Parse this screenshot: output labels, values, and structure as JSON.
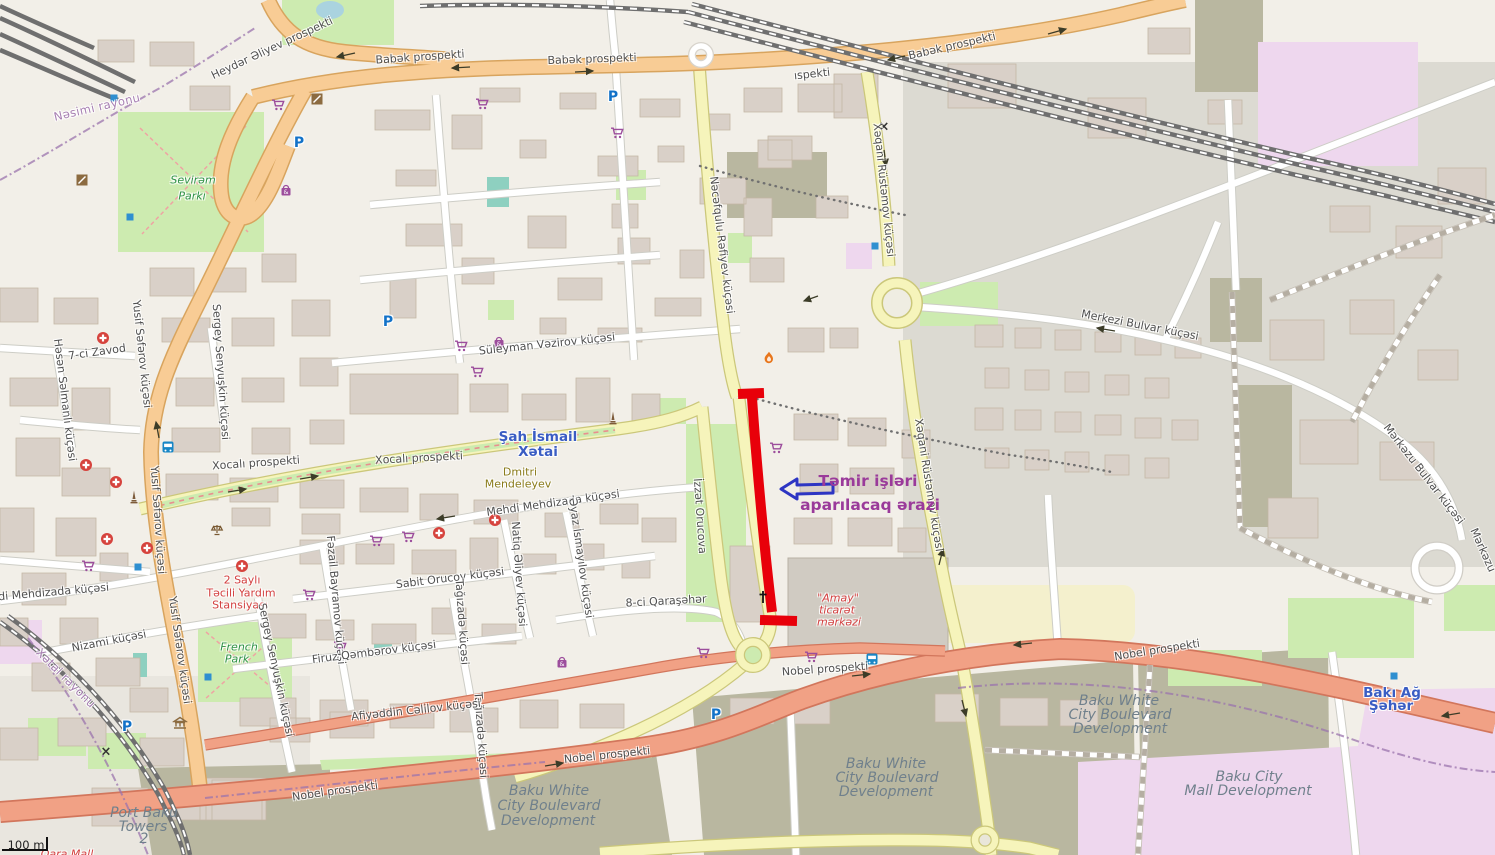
{
  "map_title": "Baku repair-area map",
  "annotation": {
    "highlight_color": "#e8000a",
    "arrow_color": "#2d35c3",
    "text_color": "#9a3a9a",
    "text": "Təmir işləri aparılacaq ərazi"
  },
  "glyphs": {
    "parking": "P",
    "mall": "&",
    "crossing": "×"
  },
  "scale_bar": {
    "label": "100 m"
  },
  "labels": [
    {
      "t": "Babək prospekti",
      "x": 420,
      "y": 57,
      "r": -4,
      "c": "street"
    },
    {
      "t": "Babək prospekti",
      "x": 592,
      "y": 59,
      "r": -2,
      "c": "street"
    },
    {
      "t": "Babək prospekti",
      "x": 952,
      "y": 46,
      "r": -13,
      "c": "street"
    },
    {
      "t": "ıspekti",
      "x": 812,
      "y": 74,
      "r": -6,
      "c": "street"
    },
    {
      "t": "Heydər Əliyev prospekti",
      "x": 272,
      "y": 48,
      "r": -25,
      "c": "street"
    },
    {
      "t": "Nəsimi rayonu",
      "x": 97,
      "y": 107,
      "r": -13,
      "c": "district"
    },
    {
      "t": "Sevirəm",
      "x": 193,
      "y": 180,
      "r": 0,
      "c": "park"
    },
    {
      "t": "Parkı",
      "x": 192,
      "y": 196,
      "r": 0,
      "c": "park"
    },
    {
      "t": "Xəqani Rüstəmov küçəsi",
      "x": 884,
      "y": 190,
      "r": 84,
      "c": "street"
    },
    {
      "t": "Xəqani Rüstəmov küçəsi",
      "x": 929,
      "y": 485,
      "r": 81,
      "c": "street"
    },
    {
      "t": "Nəcəfqulu Rəfiyev küçəsi",
      "x": 722,
      "y": 245,
      "r": 83,
      "c": "street"
    },
    {
      "t": "Süleyman Vəzirov küçəsi",
      "x": 547,
      "y": 344,
      "r": -6,
      "c": "street"
    },
    {
      "t": "Merkezi Bulvar küçəsi",
      "x": 1140,
      "y": 325,
      "r": 11,
      "c": "street"
    },
    {
      "t": "Mərkəzu Bulvar küçəsi",
      "x": 1424,
      "y": 474,
      "r": 52,
      "c": "street"
    },
    {
      "t": "Mərkəzu",
      "x": 1483,
      "y": 550,
      "r": 66,
      "c": "street"
    },
    {
      "t": "Şah İsmail",
      "x": 538,
      "y": 437,
      "r": 0,
      "c": "place-blue"
    },
    {
      "t": "Xətai",
      "x": 538,
      "y": 452,
      "r": 0,
      "c": "place-blue"
    },
    {
      "t": "Xocalı prospekti",
      "x": 256,
      "y": 463,
      "r": -4,
      "c": "street"
    },
    {
      "t": "Xocalı prospekti",
      "x": 419,
      "y": 458,
      "r": -3,
      "c": "street"
    },
    {
      "t": "Dmitri",
      "x": 520,
      "y": 472,
      "r": 0,
      "c": "poi-brown"
    },
    {
      "t": "Mendeleyev",
      "x": 518,
      "y": 484,
      "r": 0,
      "c": "poi-brown"
    },
    {
      "t": "Mehdi Mehdizada küçəsi",
      "x": 553,
      "y": 503,
      "r": -8,
      "c": "street"
    },
    {
      "t": "Mehdi Mehdizada küçəsi",
      "x": 42,
      "y": 593,
      "r": -5,
      "c": "street"
    },
    {
      "t": "İzzət Orucova",
      "x": 700,
      "y": 516,
      "r": 86,
      "c": "street"
    },
    {
      "t": "2 Saylı",
      "x": 242,
      "y": 580,
      "r": 0,
      "c": "poi-red"
    },
    {
      "t": "Təcili Yardım",
      "x": 241,
      "y": 593,
      "r": 0,
      "c": "poi-red"
    },
    {
      "t": "Stansiyası",
      "x": 240,
      "y": 605,
      "r": 0,
      "c": "poi-red"
    },
    {
      "t": "Nizami küçəsi",
      "x": 109,
      "y": 641,
      "r": -11,
      "c": "street"
    },
    {
      "t": "French",
      "x": 239,
      "y": 647,
      "r": 0,
      "c": "park"
    },
    {
      "t": "Park",
      "x": 237,
      "y": 659,
      "r": 0,
      "c": "park"
    },
    {
      "t": "Xətai rayonu",
      "x": 66,
      "y": 678,
      "r": 45,
      "c": "district"
    },
    {
      "t": "Yusif Səfərov küçəsi",
      "x": 142,
      "y": 354,
      "r": 84,
      "c": "street"
    },
    {
      "t": "Yusif Səfərov küçəsi",
      "x": 158,
      "y": 520,
      "r": 86,
      "c": "street"
    },
    {
      "t": "Yusif Səfərov küçəsi",
      "x": 180,
      "y": 650,
      "r": 82,
      "c": "street"
    },
    {
      "t": "Sergey Senyuşkin küçəsi",
      "x": 221,
      "y": 372,
      "r": 86,
      "c": "street"
    },
    {
      "t": "Sergey Senyuşkin küçəsi",
      "x": 276,
      "y": 670,
      "r": 78,
      "c": "street"
    },
    {
      "t": "7-ci Zavod",
      "x": 97,
      "y": 352,
      "r": -8,
      "c": "street"
    },
    {
      "t": "Həsən Səlmanlı küçəsi",
      "x": 65,
      "y": 400,
      "r": 83,
      "c": "street"
    },
    {
      "t": "Fəzail Bayramov küçəsi",
      "x": 336,
      "y": 600,
      "r": 85,
      "c": "street"
    },
    {
      "t": "Sabit Orucov küçəsi",
      "x": 450,
      "y": 578,
      "r": -7,
      "c": "street"
    },
    {
      "t": "Natiq Əliyev küçəsi",
      "x": 519,
      "y": 574,
      "r": 86,
      "c": "street"
    },
    {
      "t": "Əyaz İsmayılov küçəsi",
      "x": 581,
      "y": 558,
      "r": 82,
      "c": "street"
    },
    {
      "t": "Tağızadə küçəsi",
      "x": 462,
      "y": 622,
      "r": 86,
      "c": "street"
    },
    {
      "t": "Tağızadə küçəsi",
      "x": 481,
      "y": 735,
      "r": 86,
      "c": "street"
    },
    {
      "t": "8-ci Qaraşəhər",
      "x": 666,
      "y": 601,
      "r": -3,
      "c": "street"
    },
    {
      "t": "Firuz Qəmbərov küçəsi",
      "x": 374,
      "y": 652,
      "r": -7,
      "c": "street"
    },
    {
      "t": "Afiyəddin Cəlilov küçəsi",
      "x": 416,
      "y": 710,
      "r": -6,
      "c": "street"
    },
    {
      "t": "Nobel prospekti",
      "x": 825,
      "y": 669,
      "r": -4,
      "c": "street"
    },
    {
      "t": "Nobel prospekti",
      "x": 607,
      "y": 755,
      "r": -6,
      "c": "street"
    },
    {
      "t": "Nobel prospekti",
      "x": 335,
      "y": 791,
      "r": -8,
      "c": "street"
    },
    {
      "t": "Nobel prospekti",
      "x": 1157,
      "y": 650,
      "r": -9,
      "c": "street"
    },
    {
      "t": "Baku White",
      "x": 886,
      "y": 764,
      "r": 0,
      "c": "dev"
    },
    {
      "t": "City Boulevard",
      "x": 887,
      "y": 778,
      "r": 0,
      "c": "dev"
    },
    {
      "t": "Development",
      "x": 886,
      "y": 792,
      "r": 0,
      "c": "dev"
    },
    {
      "t": "Baku White",
      "x": 549,
      "y": 791,
      "r": 0,
      "c": "dev"
    },
    {
      "t": "City Boulevard",
      "x": 549,
      "y": 806,
      "r": 0,
      "c": "dev"
    },
    {
      "t": "Development",
      "x": 548,
      "y": 821,
      "r": 0,
      "c": "dev"
    },
    {
      "t": "Baku White",
      "x": 1119,
      "y": 701,
      "r": 0,
      "c": "dev"
    },
    {
      "t": "City Boulevard",
      "x": 1120,
      "y": 715,
      "r": 0,
      "c": "dev"
    },
    {
      "t": "Development",
      "x": 1120,
      "y": 729,
      "r": 0,
      "c": "dev"
    },
    {
      "t": "Baku City",
      "x": 1249,
      "y": 777,
      "r": 0,
      "c": "dev"
    },
    {
      "t": "Mall Development",
      "x": 1248,
      "y": 791,
      "r": 0,
      "c": "dev"
    },
    {
      "t": "Port Baku",
      "x": 144,
      "y": 813,
      "r": 0,
      "c": "dev"
    },
    {
      "t": "Towers",
      "x": 143,
      "y": 827,
      "r": 0,
      "c": "dev"
    },
    {
      "t": "2",
      "x": 144,
      "y": 839,
      "r": 0,
      "c": "dev"
    },
    {
      "t": "Bakı Ağ",
      "x": 1392,
      "y": 693,
      "r": 0,
      "c": "place-blue"
    },
    {
      "t": "Şəhər",
      "x": 1391,
      "y": 706,
      "r": 0,
      "c": "place-blue"
    },
    {
      "t": "\"Amay\"",
      "x": 838,
      "y": 598,
      "r": 0,
      "c": "poi-red-i"
    },
    {
      "t": "ticarət",
      "x": 837,
      "y": 610,
      "r": 0,
      "c": "poi-red-i"
    },
    {
      "t": "mərkəzi",
      "x": 839,
      "y": 622,
      "r": 0,
      "c": "poi-red-i"
    },
    {
      "t": "Təmir işləri",
      "x": 868,
      "y": 481,
      "r": 0,
      "c": "annot"
    },
    {
      "t": "aparılacaq ərazi",
      "x": 870,
      "y": 505,
      "r": 0,
      "c": "annot"
    },
    {
      "t": "100 m",
      "x": 26,
      "y": 845,
      "r": 0,
      "c": "scale"
    },
    {
      "t": "Qara Mall",
      "x": 67,
      "y": 854,
      "r": 0,
      "c": "poi-red-i"
    }
  ],
  "icons": [
    {
      "k": "cart",
      "x": 278,
      "y": 105
    },
    {
      "k": "cart",
      "x": 482,
      "y": 104
    },
    {
      "k": "cart",
      "x": 617,
      "y": 133
    },
    {
      "k": "cart",
      "x": 461,
      "y": 346
    },
    {
      "k": "cart",
      "x": 477,
      "y": 372
    },
    {
      "k": "cart",
      "x": 776,
      "y": 448
    },
    {
      "k": "cart",
      "x": 408,
      "y": 537
    },
    {
      "k": "cart",
      "x": 376,
      "y": 541
    },
    {
      "k": "cart",
      "x": 309,
      "y": 595
    },
    {
      "k": "cart",
      "x": 340,
      "y": 647
    },
    {
      "k": "cart",
      "x": 88,
      "y": 566
    },
    {
      "k": "cart",
      "x": 811,
      "y": 657
    },
    {
      "k": "cart",
      "x": 703,
      "y": 653
    },
    {
      "k": "hospital",
      "x": 103,
      "y": 338
    },
    {
      "k": "hospital",
      "x": 86,
      "y": 465
    },
    {
      "k": "hospital",
      "x": 116,
      "y": 482
    },
    {
      "k": "hospital",
      "x": 107,
      "y": 539
    },
    {
      "k": "hospital",
      "x": 147,
      "y": 548
    },
    {
      "k": "hospital",
      "x": 242,
      "y": 566
    },
    {
      "k": "hospital",
      "x": 439,
      "y": 533
    },
    {
      "k": "hospital",
      "x": 495,
      "y": 520
    },
    {
      "k": "parking",
      "x": 613,
      "y": 97
    },
    {
      "k": "parking",
      "x": 299,
      "y": 143
    },
    {
      "k": "parking",
      "x": 388,
      "y": 322
    },
    {
      "k": "parking",
      "x": 127,
      "y": 727
    },
    {
      "k": "parking",
      "x": 716,
      "y": 715
    },
    {
      "k": "bus",
      "x": 168,
      "y": 447
    },
    {
      "k": "bus",
      "x": 872,
      "y": 659
    },
    {
      "k": "museum",
      "x": 180,
      "y": 723
    },
    {
      "k": "scales",
      "x": 217,
      "y": 530
    },
    {
      "k": "monument",
      "x": 613,
      "y": 418
    },
    {
      "k": "monument",
      "x": 134,
      "y": 497
    },
    {
      "k": "flame",
      "x": 769,
      "y": 358
    },
    {
      "k": "church",
      "x": 763,
      "y": 597
    },
    {
      "k": "mall",
      "x": 286,
      "y": 190
    },
    {
      "k": "mall",
      "x": 499,
      "y": 342
    },
    {
      "k": "mall",
      "x": 562,
      "y": 662
    },
    {
      "k": "crossing",
      "x": 106,
      "y": 752
    },
    {
      "k": "crossing",
      "x": 884,
      "y": 127
    },
    {
      "k": "dot",
      "x": 114,
      "y": 98
    },
    {
      "k": "dot",
      "x": 130,
      "y": 217
    },
    {
      "k": "dot",
      "x": 875,
      "y": 246
    },
    {
      "k": "dot",
      "x": 138,
      "y": 567
    },
    {
      "k": "dot",
      "x": 208,
      "y": 677
    },
    {
      "k": "dot",
      "x": 1394,
      "y": 676
    },
    {
      "k": "poi2",
      "x": 82,
      "y": 180
    },
    {
      "k": "poi2",
      "x": 317,
      "y": 99
    }
  ]
}
